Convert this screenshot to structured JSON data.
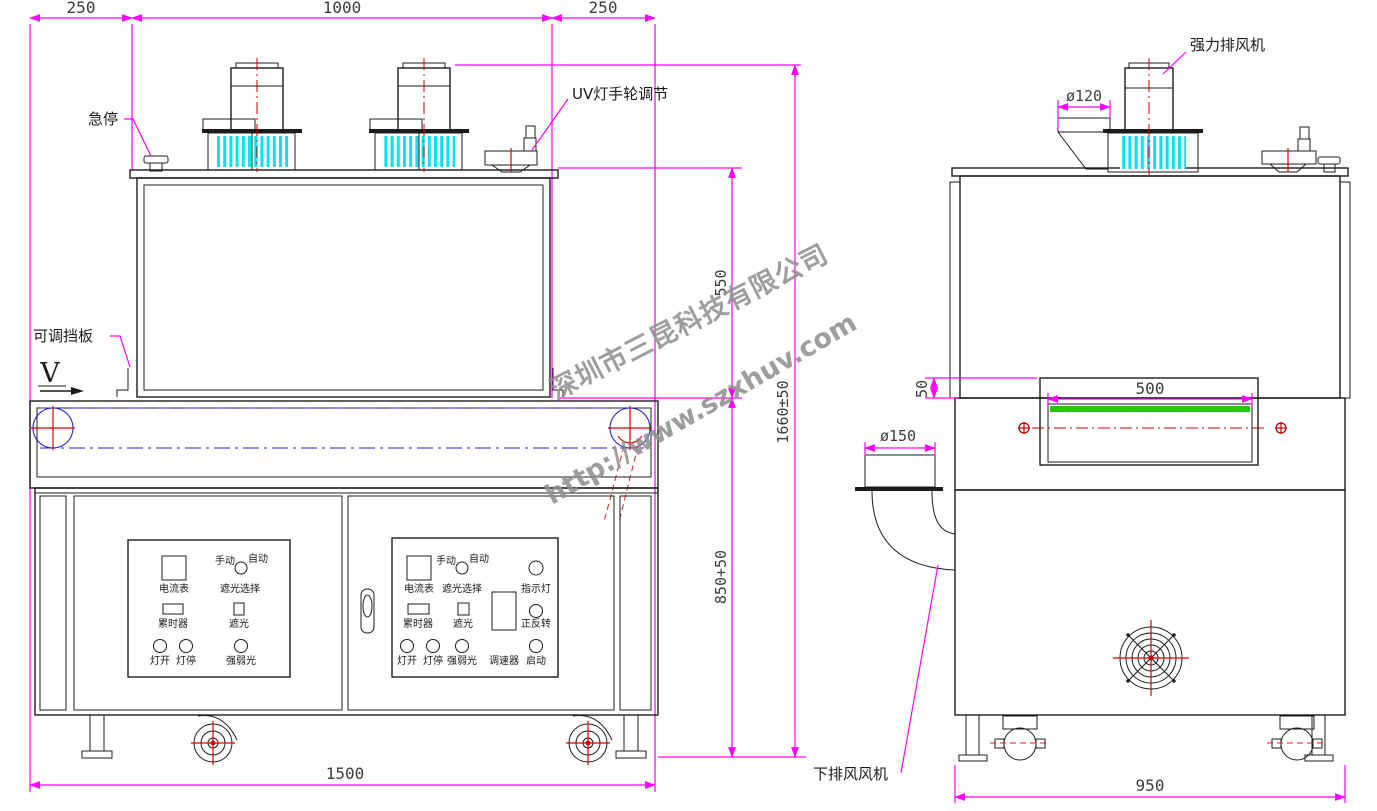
{
  "watermark": {
    "company": "深圳市三昆科技有限公司",
    "url": "http://www.szxhuv.com"
  },
  "front_view": {
    "top_dims": [
      "250",
      "1000",
      "250"
    ],
    "bottom_dim": "1500",
    "right_dims": {
      "chamber_height": "550",
      "cabinet_height": "850+50",
      "total_height": "1660±50"
    },
    "callouts": {
      "emergency_stop": "急停",
      "adjustable_baffle": "可调挡板",
      "uv_lamp_handwheel": "UV灯手轮调节"
    },
    "belt_direction": "V",
    "panel_labels": {
      "ammeter": "电流表",
      "manual": "手动",
      "auto": "自动",
      "shade_select": "遮光选择",
      "timer": "累时器",
      "shade": "遮光",
      "lamp_on": "灯开",
      "lamp_off": "灯停",
      "light_intensity": "强弱光",
      "indicator_light": "指示灯",
      "forward_reverse": "正反转",
      "speed_controller": "调速器",
      "start": "启动"
    }
  },
  "side_view": {
    "dims": {
      "exhaust_duct": "ø120",
      "belt_width": "500",
      "belt_offset": "50",
      "lower_duct": "ø150",
      "overall_width": "950"
    },
    "callouts": {
      "strong_exhaust_fan": "强力排风机",
      "lower_exhaust_fan": "下排风风机"
    }
  },
  "colors": {
    "dimension": "#ff00ff",
    "centerline_red": "#cc0000",
    "roller_blue": "#2222cc",
    "fins_cyan": "#0ae0ee",
    "belt_green": "#22cc00",
    "watermark_gray": "#8e8e8e"
  }
}
